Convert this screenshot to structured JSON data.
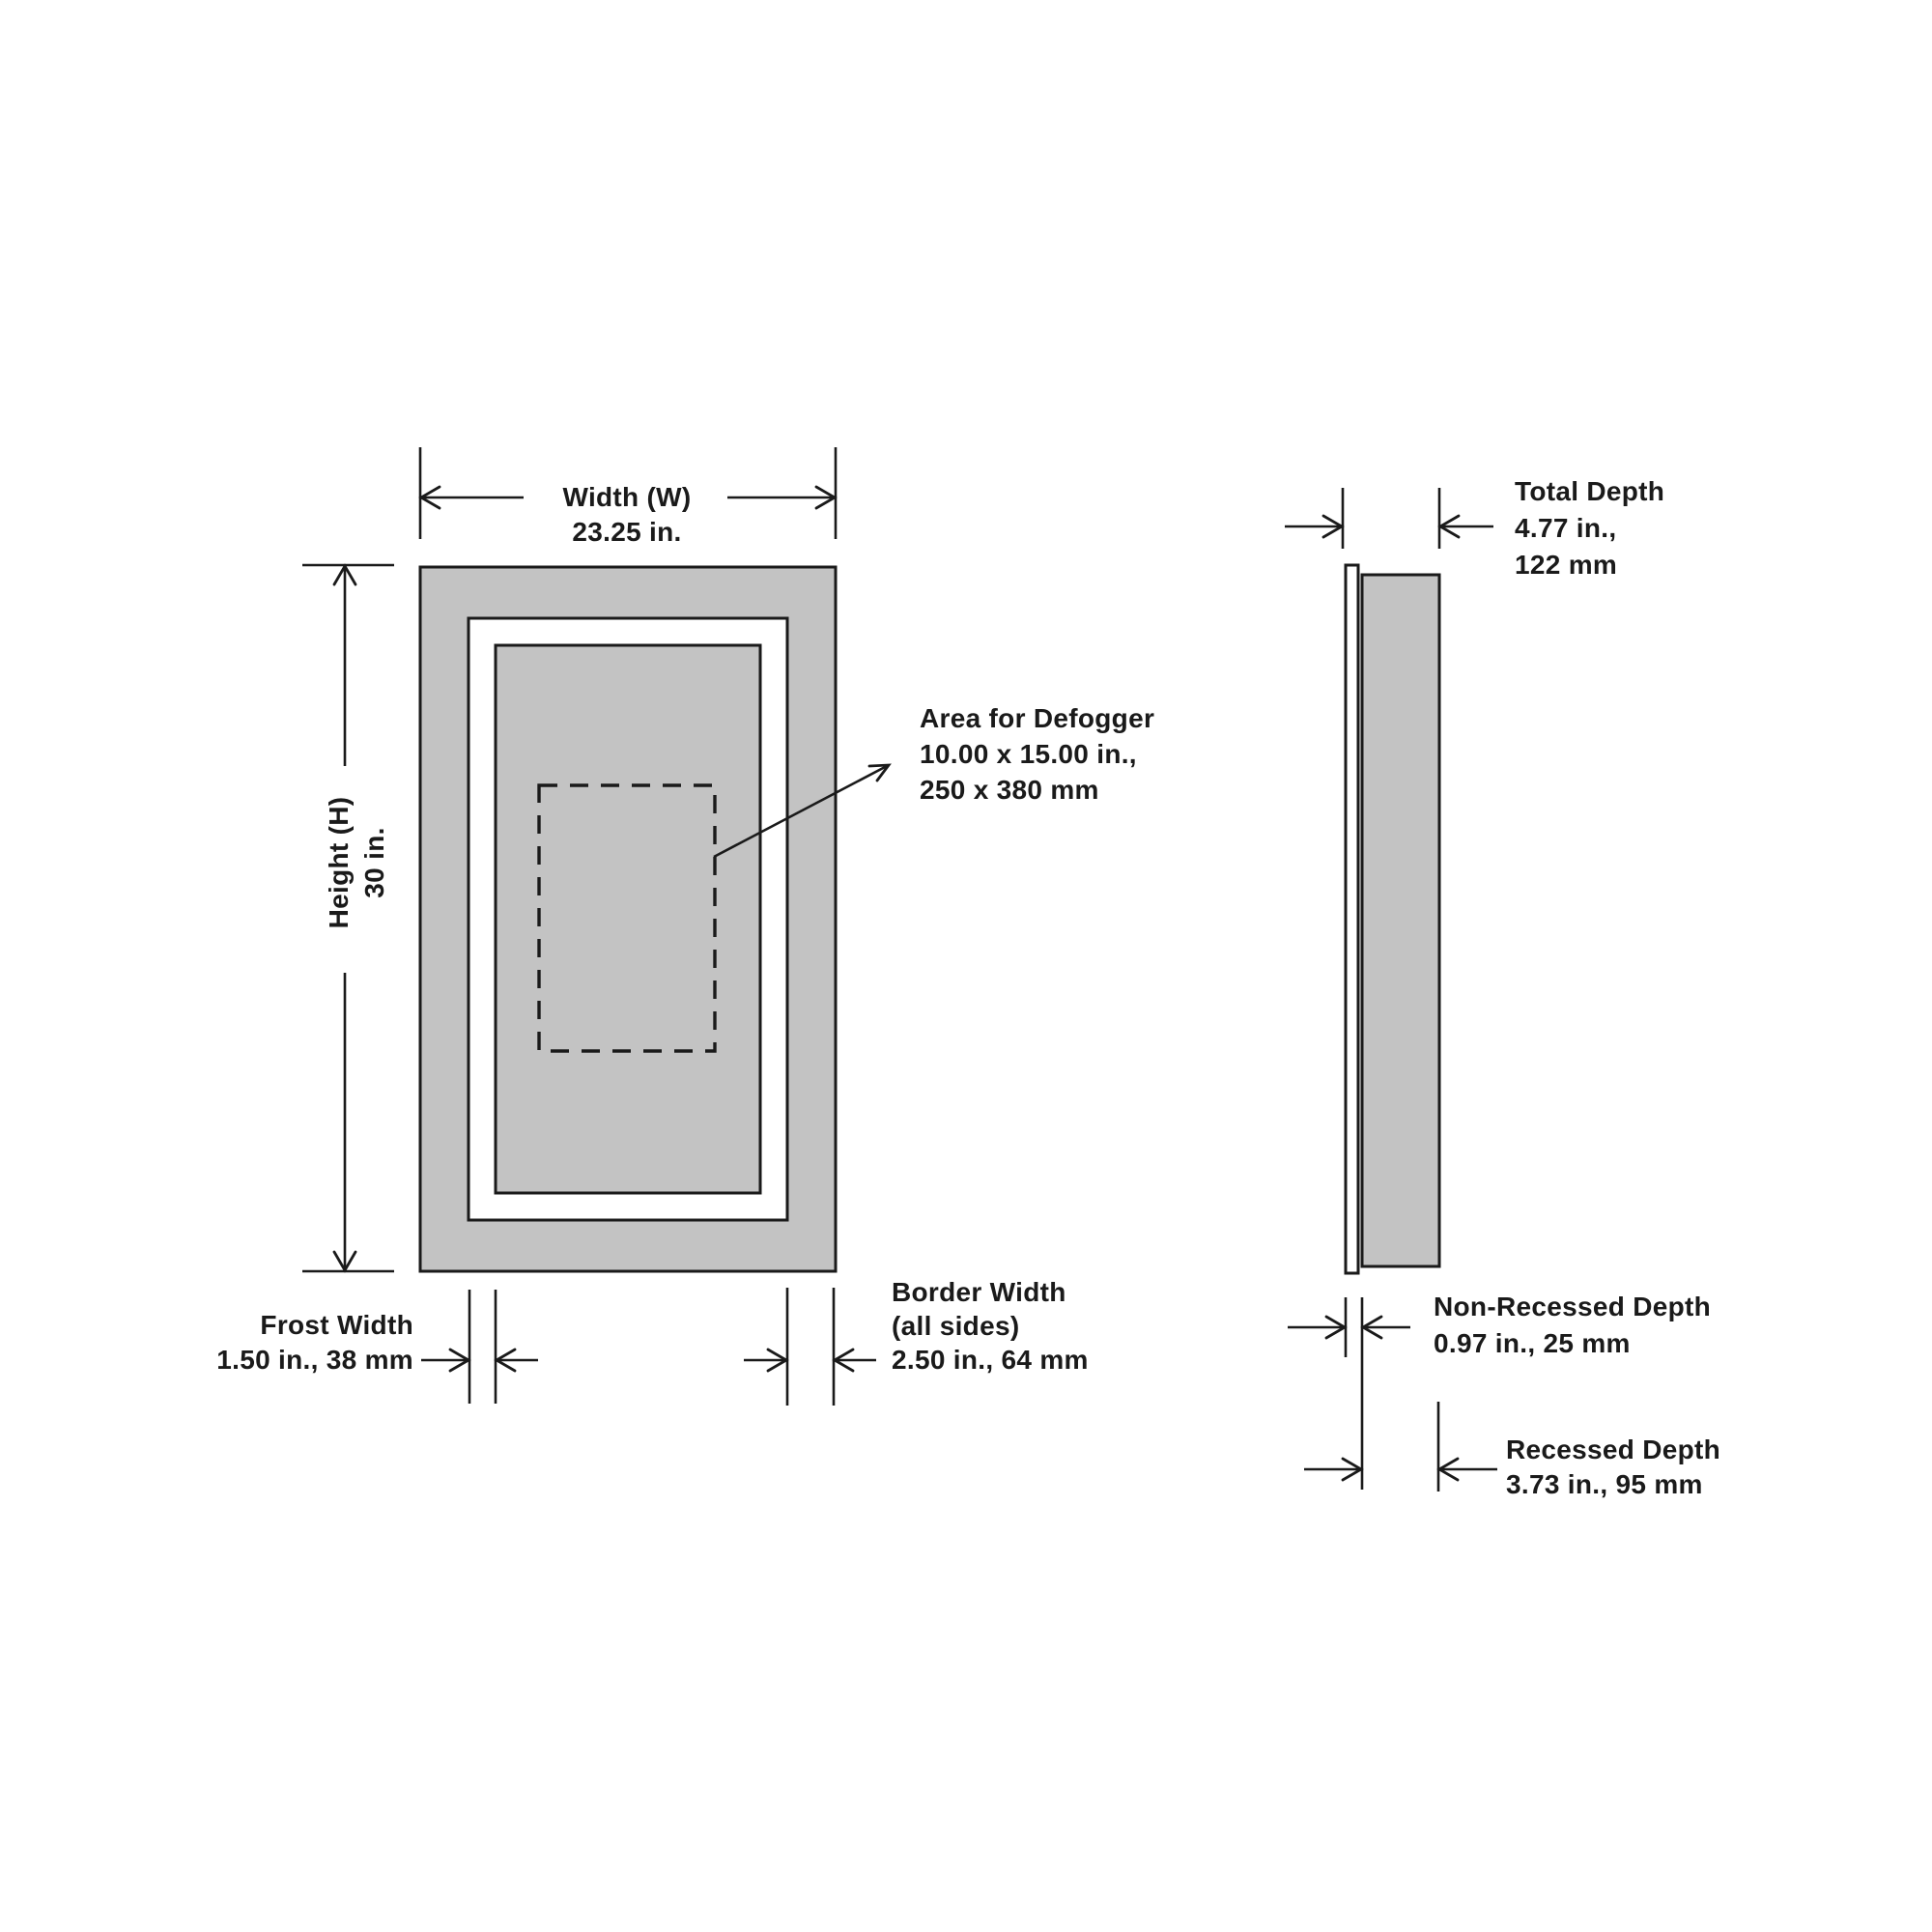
{
  "front_view": {
    "width_dimension": {
      "label": "Width (W)",
      "value": "23.25 in."
    },
    "height_dimension": {
      "label": "Height (H)",
      "value": "30 in."
    },
    "defogger": {
      "title": "Area for Defogger",
      "size_in": "10.00 x 15.00 in.,",
      "size_mm": "250 x 380 mm"
    },
    "frost_width": {
      "label": "Frost Width",
      "value": "1.50 in., 38 mm"
    },
    "border_width": {
      "label": "Border Width",
      "scope": "(all sides)",
      "value": "2.50 in., 64 mm"
    }
  },
  "side_view": {
    "total_depth": {
      "label": "Total Depth",
      "value_in": "4.77 in.,",
      "value_mm": "122 mm"
    },
    "non_recessed_depth": {
      "label": "Non-Recessed Depth",
      "value": "0.97 in., 25 mm"
    },
    "recessed_depth": {
      "label": "Recessed Depth",
      "value": "3.73 in., 95 mm"
    }
  },
  "colors": {
    "panel_fill": "#c3c3c3",
    "line": "#1a1a1a",
    "background": "#ffffff"
  }
}
